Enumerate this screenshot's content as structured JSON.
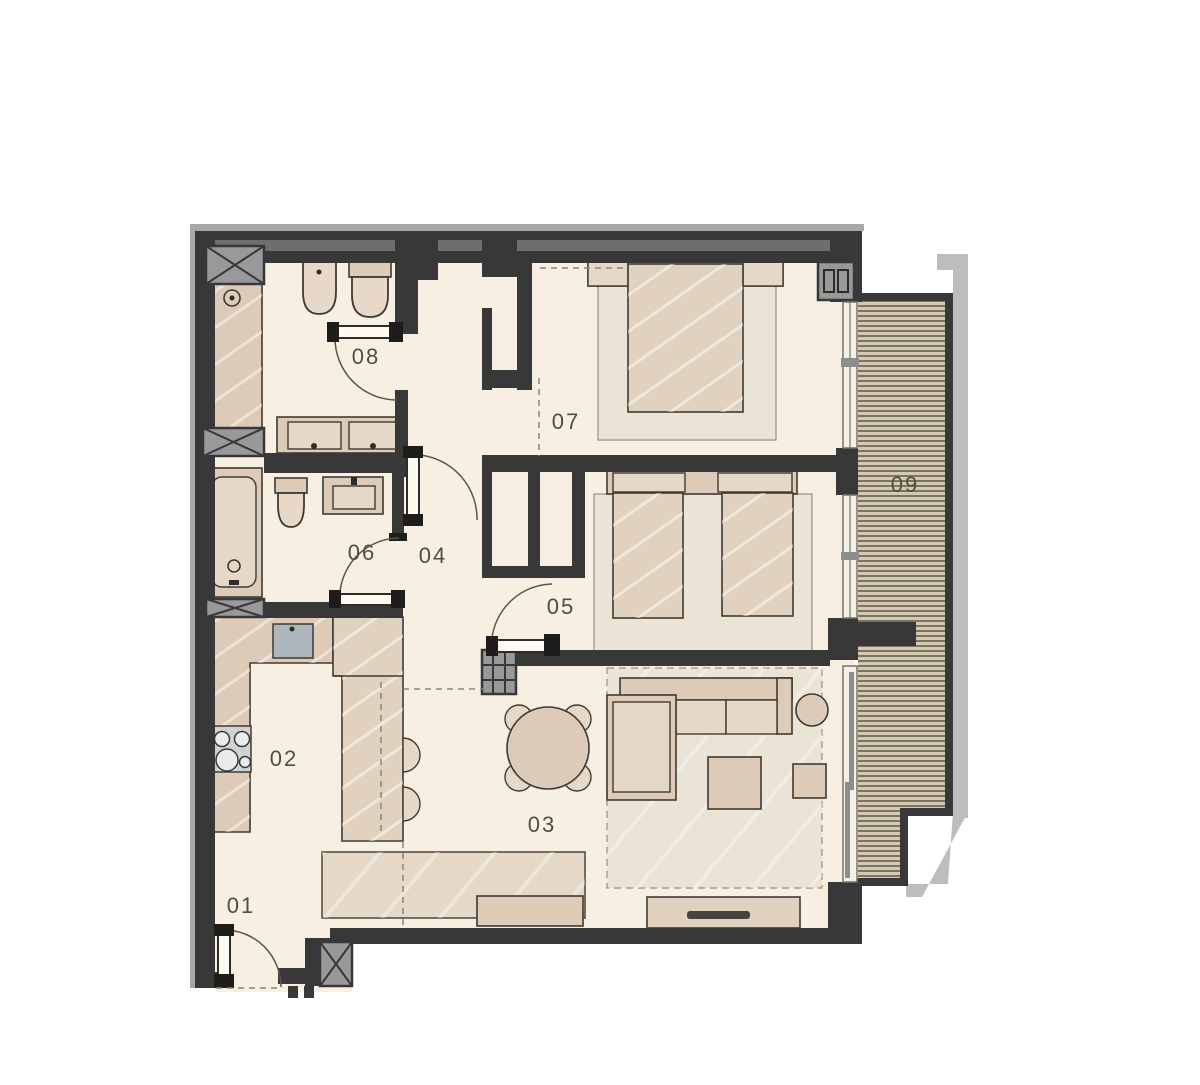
{
  "page": {
    "background": "#ffffff",
    "type": "apartment floor plan"
  },
  "colors": {
    "pagebg": "#ffffff",
    "wall": "#383838",
    "wallLight": "#6e6e6e",
    "wallEdge": "#a8a8a8",
    "floor": "#f7f0e2",
    "furn": "#ddcbb8",
    "furnLight": "#e6d8c7",
    "furnMid": "#e1d2c0",
    "rug": "#ebe3d5",
    "fixture": "#e7d8c7",
    "sink": "#aeb7bd",
    "stove": "#cfd3d6",
    "shaft": "#99999b",
    "line": "#3d3a35",
    "dash": "#8b857a",
    "deckBase": "#d5cab0",
    "deckLine": "#6f6a5c",
    "concrete": "#bdbdbd",
    "label": "#514d45"
  },
  "plan": {
    "rooms": [
      {
        "id": "r01",
        "label": "01"
      },
      {
        "id": "r02",
        "label": "02"
      },
      {
        "id": "r03",
        "label": "03"
      },
      {
        "id": "r04",
        "label": "04"
      },
      {
        "id": "r05",
        "label": "05"
      },
      {
        "id": "r06",
        "label": "06"
      },
      {
        "id": "r07",
        "label": "07"
      },
      {
        "id": "r08",
        "label": "08"
      },
      {
        "id": "r09",
        "label": "09"
      }
    ]
  }
}
